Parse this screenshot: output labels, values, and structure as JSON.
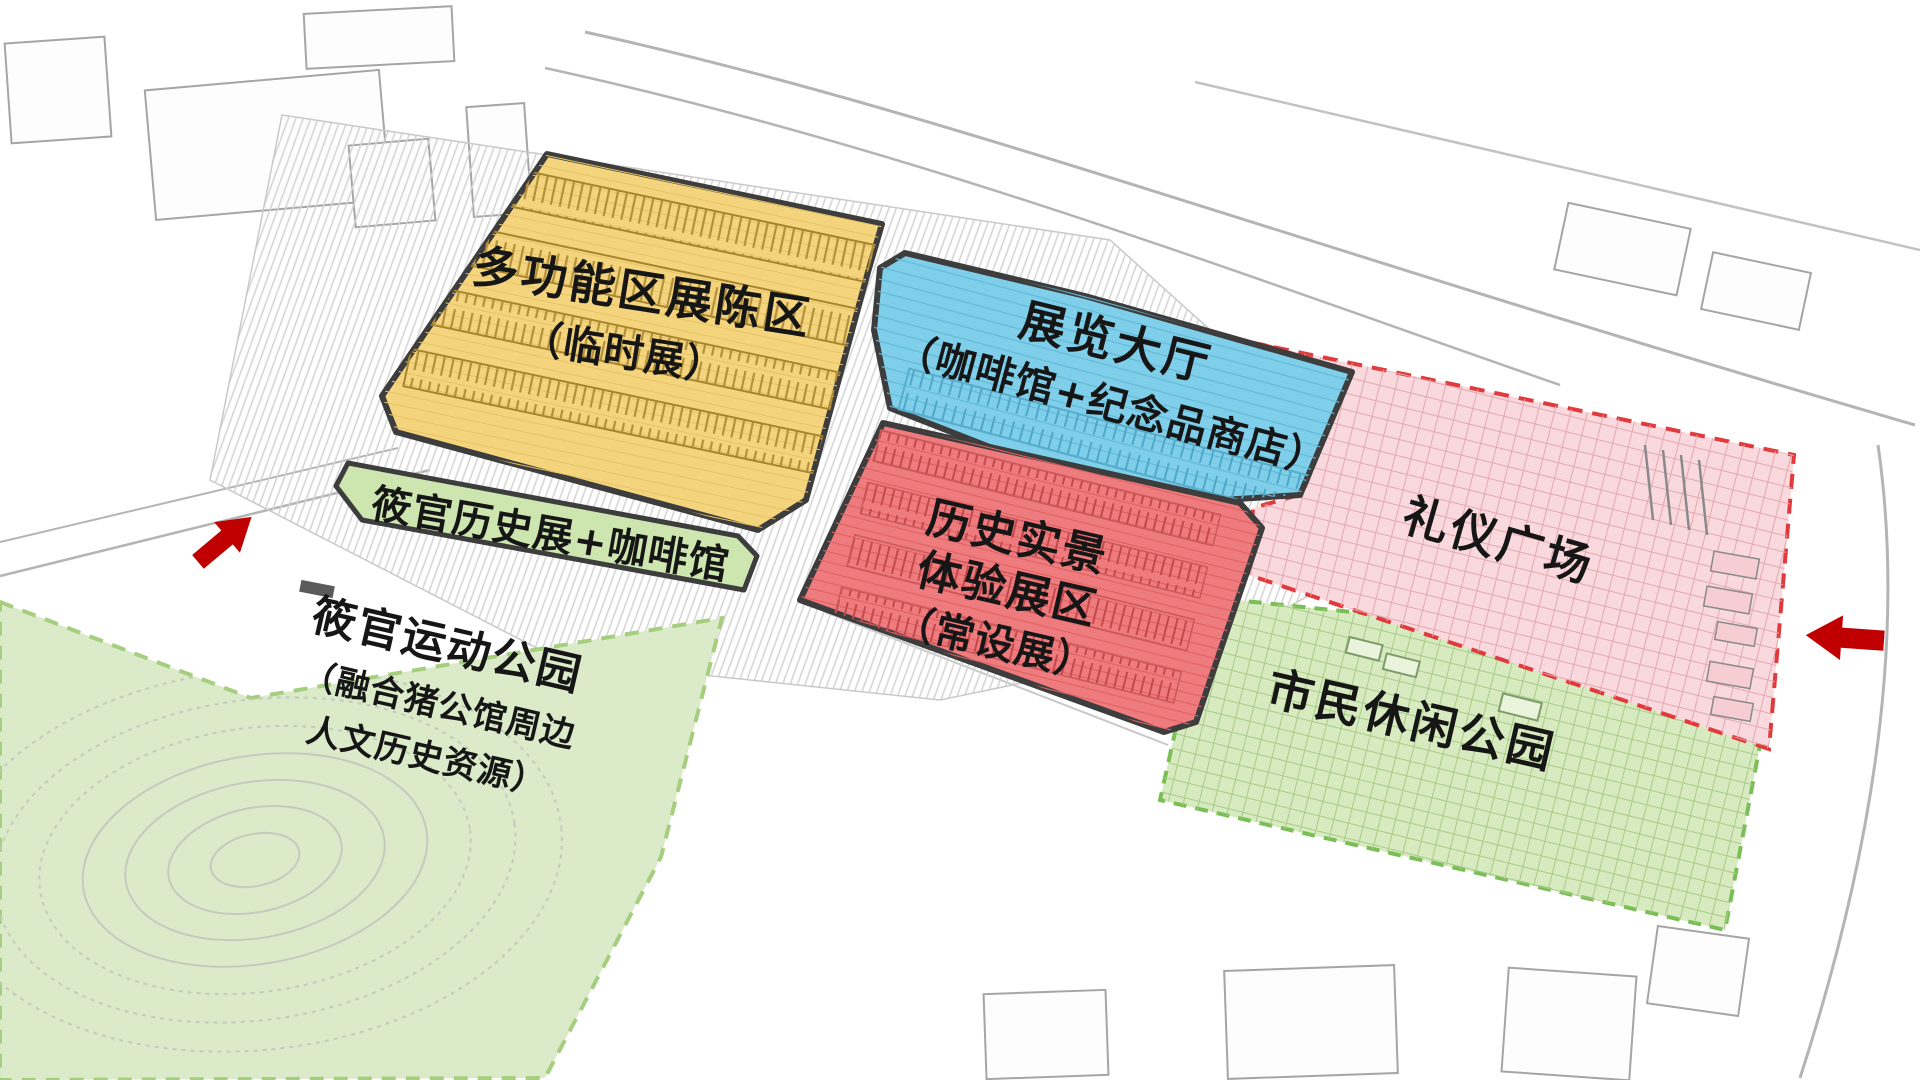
{
  "diagram": {
    "type": "site-plan-functional-zoning",
    "zones": {
      "temporary_exhibition": {
        "line1": "多功能区展陈区",
        "line2": "（临时展）",
        "color": "#F4D57E",
        "outline": "#3D3D3D"
      },
      "exhibition_hall": {
        "line1": "展览大厅",
        "line2": "（咖啡馆+纪念品商店）",
        "color": "#7FCFEA",
        "outline": "#3D3D3D"
      },
      "history_cafe_strip": {
        "label": "筱官历史展+咖啡馆",
        "color": "#CDE6AF",
        "outline": "#3D3D3D"
      },
      "sports_park": {
        "line1": "筱官运动公园",
        "line2": "（融合猪公馆周边",
        "line3": "人文历史资源）",
        "color": "#DBEAC8",
        "border": "#A5CE7E"
      },
      "permanent_exhibition": {
        "line1": "历史实景",
        "line2": "体验展区",
        "line3": "（常设展）",
        "color": "#EE7B7D",
        "outline": "#3D3D3D"
      },
      "ceremony_plaza": {
        "label": "礼仪广场",
        "color": "#F9D9DD",
        "border": "#E03A3C"
      },
      "citizen_park": {
        "label": "市民休闲公园",
        "color": "#D7EAC0",
        "border": "#7ABF56"
      }
    },
    "markers": {
      "entrance_arrow_color": "#C00000",
      "entrance_left": "northwest entrance arrow",
      "entrance_right": "east entrance arrow"
    }
  }
}
